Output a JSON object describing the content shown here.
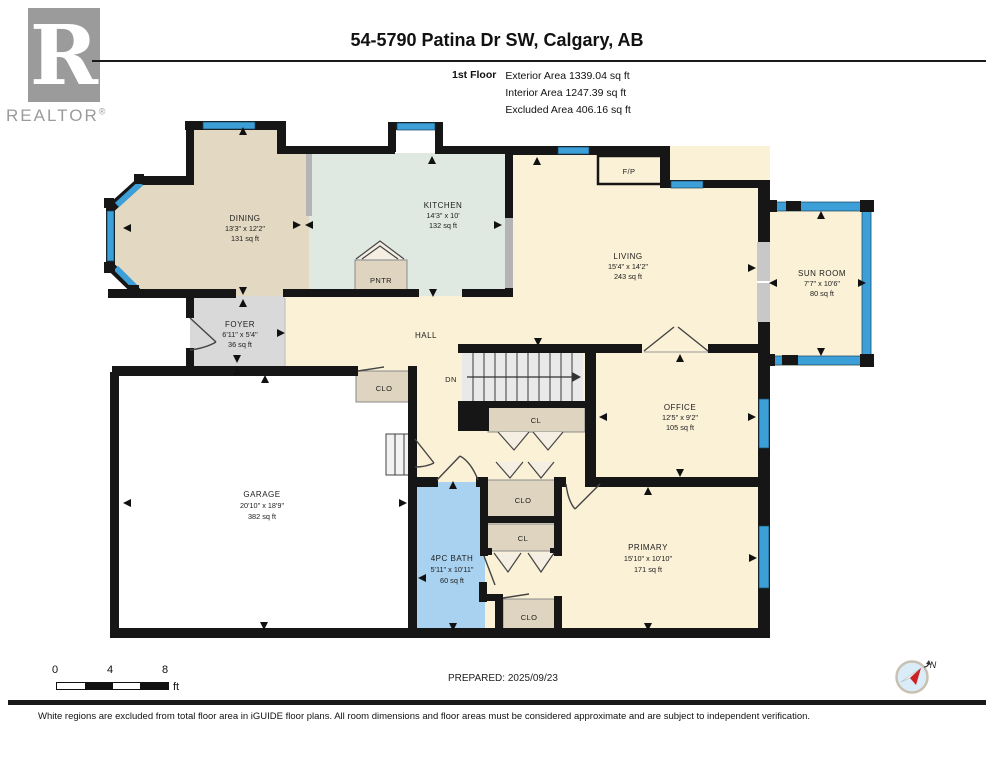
{
  "header": {
    "logo": {
      "letter": "R",
      "brand": "REALTOR",
      "registered": "®"
    },
    "title": "54-5790 Patina Dr SW, Calgary, AB",
    "floor_label": "1st Floor",
    "area_lines": [
      "Exterior Area 1339.04 sq ft",
      "Interior Area 1247.39 sq ft",
      "Excluded Area 406.16 sq ft"
    ]
  },
  "rooms": {
    "dining": {
      "name": "DINING",
      "dims": "13'3\" x 12'2\"",
      "area": "131 sq ft"
    },
    "kitchen": {
      "name": "KITCHEN",
      "dims": "14'3\" x 10'",
      "area": "132 sq ft"
    },
    "living": {
      "name": "LIVING",
      "dims": "15'4\" x 14'2\"",
      "area": "243 sq ft"
    },
    "sunroom": {
      "name": "SUN ROOM",
      "dims": "7'7\" x 10'6\"",
      "area": "80 sq ft"
    },
    "foyer": {
      "name": "FOYER",
      "dims": "6'11\" x 5'4\"",
      "area": "36 sq ft"
    },
    "office": {
      "name": "OFFICE",
      "dims": "12'5\" x 9'2\"",
      "area": "105 sq ft"
    },
    "garage": {
      "name": "GARAGE",
      "dims": "20'10\" x 18'9\"",
      "area": "382 sq ft"
    },
    "bath": {
      "name": "4PC BATH",
      "dims": "5'11\" x 10'11\"",
      "area": "60 sq ft"
    },
    "primary": {
      "name": "PRIMARY",
      "dims": "15'10\" x 10'10\"",
      "area": "171 sq ft"
    }
  },
  "labels": {
    "hall": "HALL",
    "pantry": "PNTR",
    "fireplace": "F/P",
    "stairs_down": "DN",
    "closet_small": "CL",
    "closet": "CLO"
  },
  "scale_bar": {
    "ticks": [
      "0",
      "4",
      "8"
    ],
    "unit": "ft"
  },
  "compass": {
    "north_label": "N"
  },
  "footer": {
    "prepared": "PREPARED: 2025/09/23",
    "disclaimer": "White regions are excluded from total floor area in iGUIDE floor plans. All room dimensions and floor areas must be considered approximate and are subject to independent verification."
  },
  "colors": {
    "wall": "#161616",
    "cream": "#fbf1d6",
    "dining": "#e3d9c3",
    "kitchen": "#dfe9e2",
    "foyer": "#d9d9d9",
    "bath": "#a9d2f0",
    "closet": "#ded4c0",
    "window": "#3d9fd8",
    "garage": "#ffffff",
    "stairs": "#e9e9e9"
  }
}
